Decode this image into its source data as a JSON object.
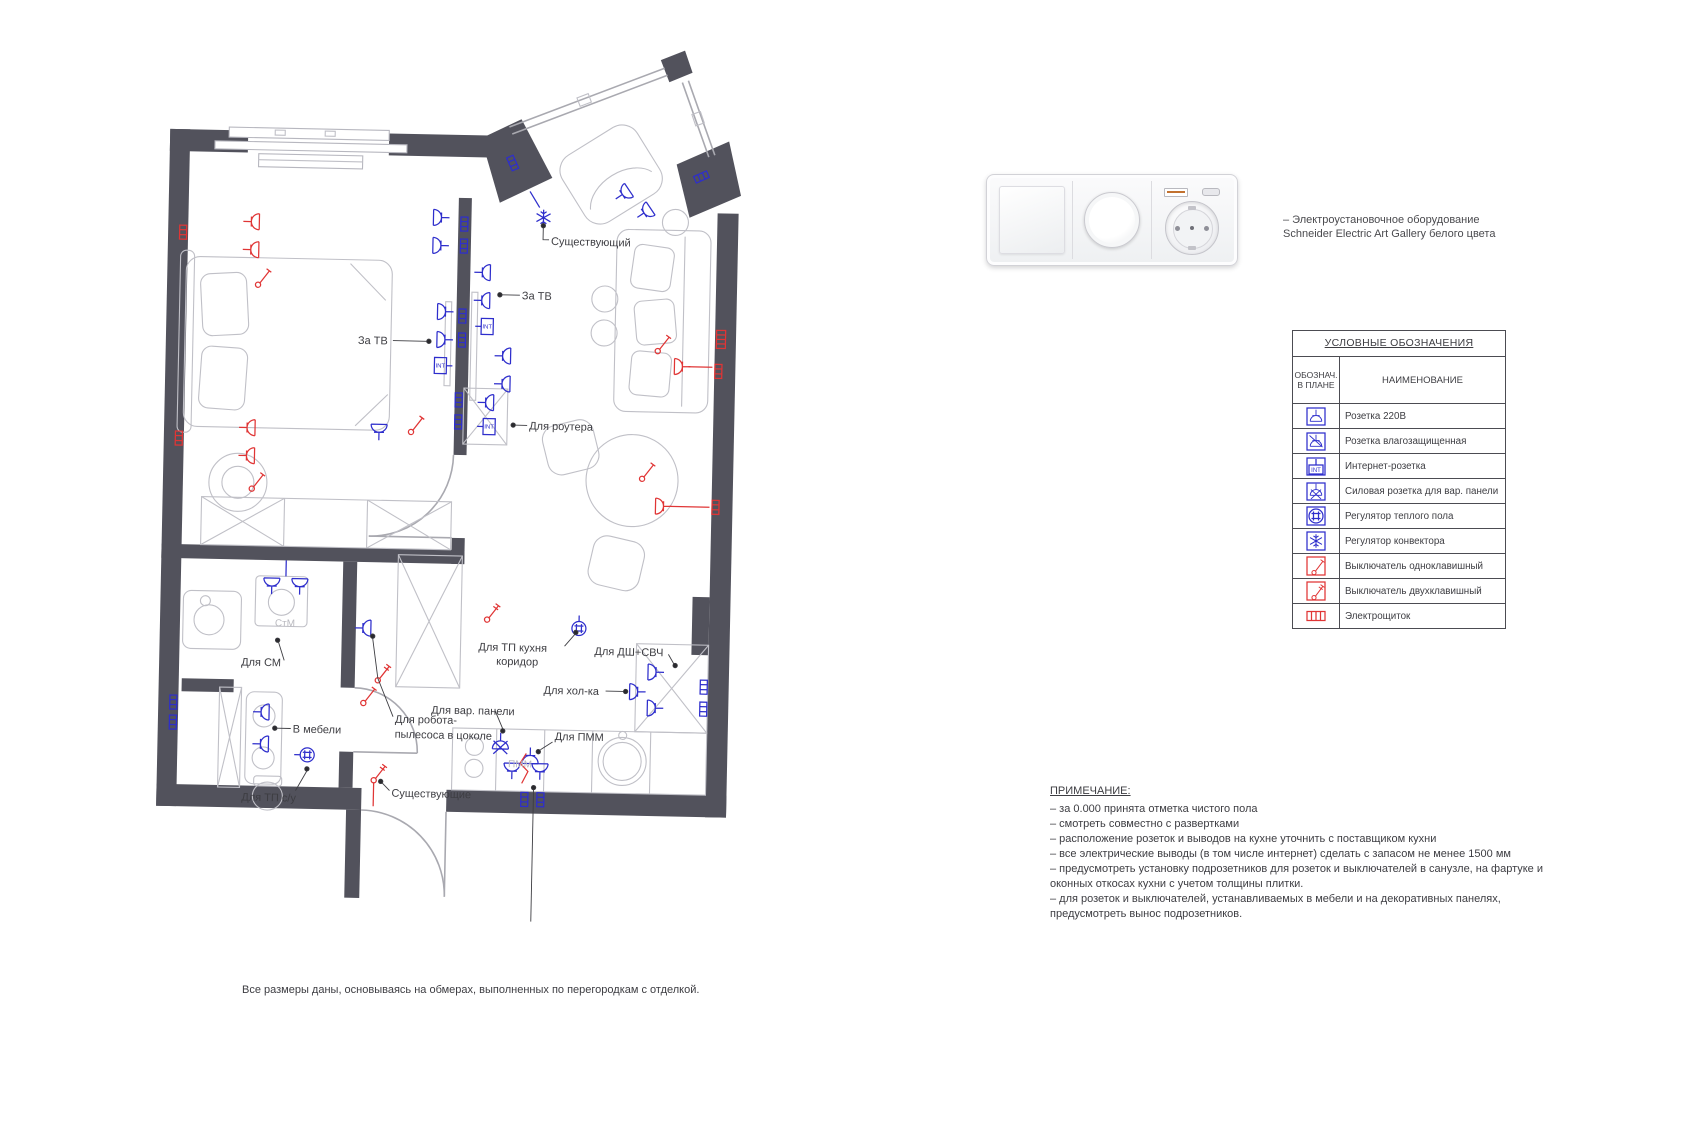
{
  "product": {
    "caption_line1": "– Электроустановочное оборудование",
    "caption_line2": "Schneider Electric Art Gallery белого цвета",
    "modules": [
      "rocker-switch",
      "dimmer-knob",
      "schuko-socket-with-usb"
    ]
  },
  "legend": {
    "title": "УСЛОВНЫЕ ОБОЗНАЧЕНИЯ",
    "col1_header_line1": "ОБОЗНАЧ.",
    "col1_header_line2": "В ПЛАНЕ",
    "col2_header": "НАИМЕНОВАНИЕ",
    "rows": [
      {
        "symbol": "socket-220v",
        "name": "Розетка 220В"
      },
      {
        "symbol": "socket-waterproof",
        "name": "Розетка влагозащищенная"
      },
      {
        "symbol": "socket-internet",
        "name": "Интернет-розетка"
      },
      {
        "symbol": "socket-power-hob",
        "name": "Силовая розетка для вар. панели"
      },
      {
        "symbol": "floor-heating-regulator",
        "name": "Регулятор теплого пола"
      },
      {
        "symbol": "convector-regulator",
        "name": "Регулятор конвектора"
      },
      {
        "symbol": "switch-single",
        "name": "Выключатель одноклавишный"
      },
      {
        "symbol": "switch-double",
        "name": "Выключатель двухклавишный"
      },
      {
        "symbol": "electrical-panel",
        "name": "Электрощиток"
      }
    ]
  },
  "notes": {
    "title": "ПРИМЕЧАНИЕ:",
    "items": [
      "– за 0.000 принята отметка чистого пола",
      "– смотреть совместно с развертками",
      "– расположение розеток и выводов на кухне уточнить с поставщиком кухни",
      "– все электрические выводы (в том числе интернет) сделать с запасом не менее 1500 мм",
      "– предусмотреть установку подрозетников для розеток и выключателей в санузле, на фартуке и оконных откосах кухни с учетом толщины плитки.",
      "– для розеток и выключателей, устанавливаемых в мебели и на декоративных панелях, предусмотреть вынос подрозетников."
    ]
  },
  "plan": {
    "labels": {
      "existing_top": "Существующий",
      "za_tv_living": "За ТВ",
      "za_tv_bedroom": "За ТВ",
      "router": "Для роутера",
      "washer": "Для СМ",
      "stm": "СтМ",
      "in_furniture": "В мебели",
      "tp_bathroom": "Для ТП с/у",
      "existing_bottom": "Существующие",
      "robot_line1": "Для робота-",
      "robot_line2": "пылесоса в цоколе",
      "tp_kitchen_line1": "Для ТП кухня",
      "tp_kitchen_line2": "коридор",
      "dsh_svch": "Для ДШ+СВЧ",
      "fridge": "Для хол-ка",
      "hob": "Для вар. панели",
      "pmm_socket": "Для ПММ",
      "pmm": "ПММ",
      "hood": "Вывод для вытяжки",
      "int": "INT"
    }
  },
  "footer": {
    "caption": "Все размеры даны, основываясь на обмерах, выполненных по перегородкам с отделкой."
  },
  "colors": {
    "wall": "#52525c",
    "symbol_blue": "#2e2ecc",
    "symbol_red": "#e03535",
    "furniture_grey": "#c0c0c7"
  }
}
